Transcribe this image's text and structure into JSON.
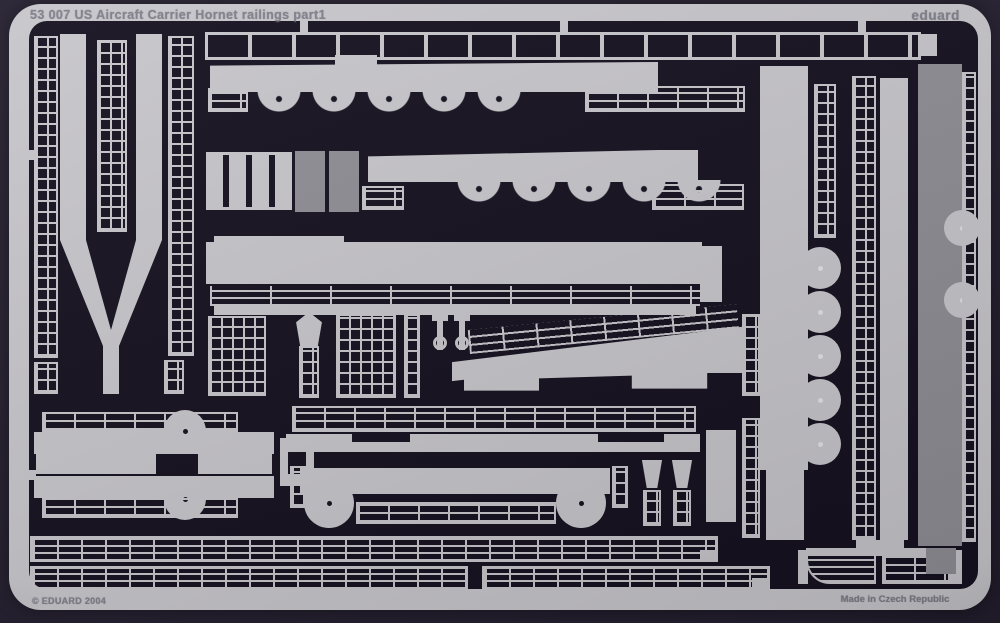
{
  "photo": {
    "sheet_code_title": "53 007  US Aircraft Carrier Hornet railings  part1",
    "brand": "eduard",
    "copyright": "© EDUARD 2004",
    "origin": "Made in Czech Republic"
  },
  "colors": {
    "backdrop": "#251f30",
    "field": "#15101f",
    "metal": "#c7c6cb",
    "metal_mid": "#8f8e95",
    "metal_high": "#e3e3e8",
    "engrave": "#807f8a"
  }
}
